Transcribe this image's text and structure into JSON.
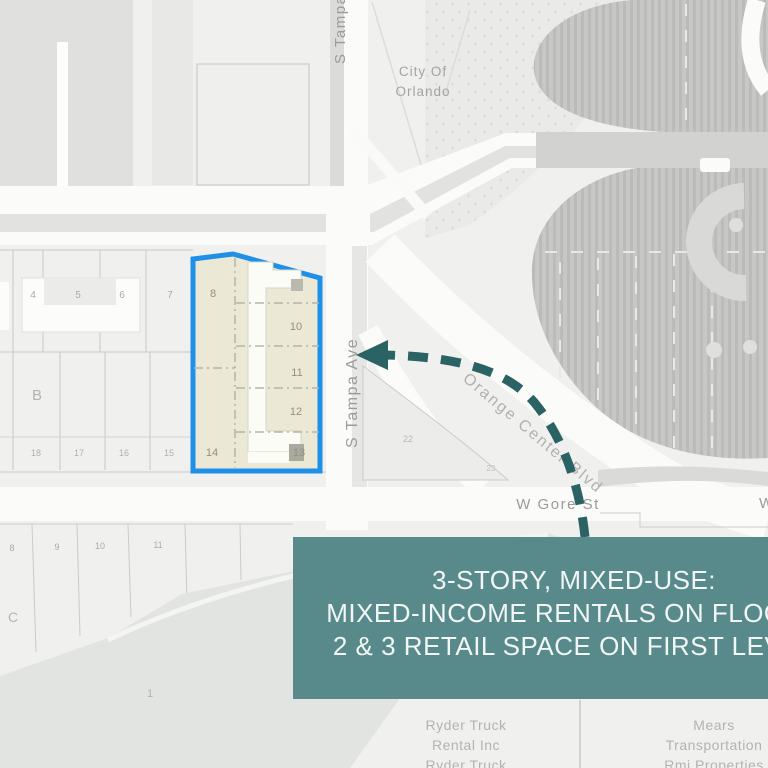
{
  "annotation": {
    "box": {
      "line1": "3-STORY, MIXED-USE:",
      "line2": "MIXED-INCOME RENTALS ON FLOORS",
      "line3": "2 & 3 RETAIL SPACE ON FIRST LEVEL",
      "bg_color": "#588a8b",
      "text_color": "#f2f6f5"
    },
    "arrow_color": "#2b6364"
  },
  "map": {
    "labels": {
      "city_line1": "City Of",
      "city_line2": "Orlando",
      "s_tampa_top": "S Tampa Ave",
      "s_tampa_mid": "S Tampa Ave",
      "orange_center_blvd": "Orange Center Blvd",
      "w_gore_st": "W Gore St",
      "w_fragment": "W"
    },
    "businesses": {
      "ryder_line1": "Ryder Truck",
      "ryder_line2": "Rental Inc",
      "ryder_line3": "Ryder Truck",
      "mears_line1": "Mears",
      "mears_line2": "Transportation",
      "mears_line3": "Rmi Properties"
    },
    "parcels": {
      "highlighted": {
        "outline_color": "#1e90e8",
        "fill_color": "#ebe8d5",
        "lots": [
          "8",
          "10",
          "11",
          "12",
          "13",
          "14"
        ]
      },
      "row_top": [
        "4",
        "5",
        "6",
        "7"
      ],
      "block_label": "B",
      "row_bottom": [
        "18",
        "17",
        "16",
        "15"
      ],
      "south_row": [
        "8",
        "9",
        "10",
        "11"
      ],
      "south_block_label": "C",
      "field_label": "1",
      "island": [
        "22",
        "23"
      ]
    }
  }
}
